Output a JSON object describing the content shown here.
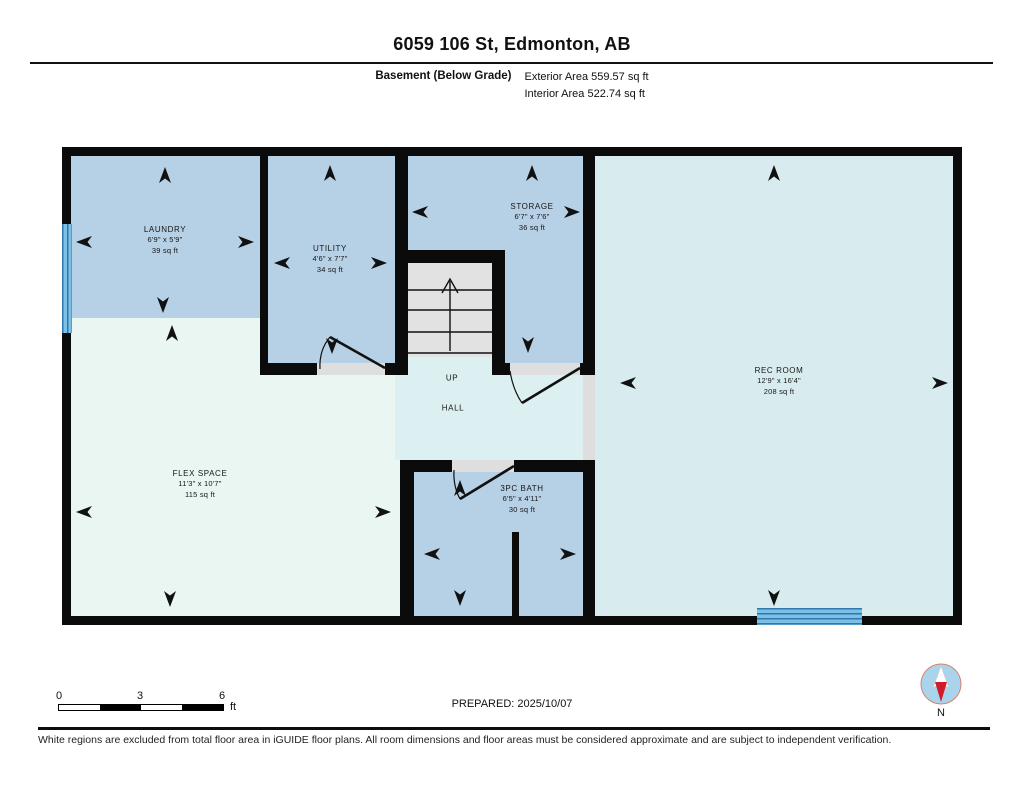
{
  "header": {
    "title": "6059 106 St, Edmonton, AB",
    "floor_label": "Basement (Below Grade)",
    "exterior_area": "Exterior Area 559.57 sq ft",
    "interior_area": "Interior Area 522.74 sq ft"
  },
  "rooms": [
    {
      "id": "laundry",
      "name": "LAUNDRY",
      "dims": "6'9\" x 5'9\"",
      "area": "39 sq ft"
    },
    {
      "id": "utility",
      "name": "UTILITY",
      "dims": "4'6\" x 7'7\"",
      "area": "34 sq ft"
    },
    {
      "id": "storage",
      "name": "STORAGE",
      "dims": "6'7\" x 7'6\"",
      "area": "36 sq ft"
    },
    {
      "id": "rec",
      "name": "REC ROOM",
      "dims": "12'9\" x 16'4\"",
      "area": "208 sq ft"
    },
    {
      "id": "flex",
      "name": "FLEX SPACE",
      "dims": "11'3\" x 10'7\"",
      "area": "115 sq ft"
    },
    {
      "id": "bath",
      "name": "3PC BATH",
      "dims": "6'5\" x 4'11\"",
      "area": "30 sq ft"
    }
  ],
  "labels": {
    "up": "UP",
    "hall": "HALL",
    "north": "N"
  },
  "footer": {
    "scale": {
      "tick0": "0",
      "tick3": "3",
      "tick6": "6",
      "unit": "ft"
    },
    "prepared": "PREPARED: 2025/10/07",
    "disclaimer": "White regions are excluded from total floor area in iGUIDE floor plans. All room dimensions and floor areas must be considered approximate and are subject to independent verification."
  },
  "colors": {
    "wall": "#0b0b0b",
    "room_blue": "#b6d0e6",
    "room_mint": "#e9f6f1",
    "room_cyan": "#dcf0f1",
    "room_rec": "#d8ecf0",
    "stair_gray": "#e2e2e2",
    "window_blue": "#7cc0e6",
    "window_line": "#2f77ae",
    "compass_fill": "#a9d4ec",
    "compass_red": "#cf1b2b"
  }
}
